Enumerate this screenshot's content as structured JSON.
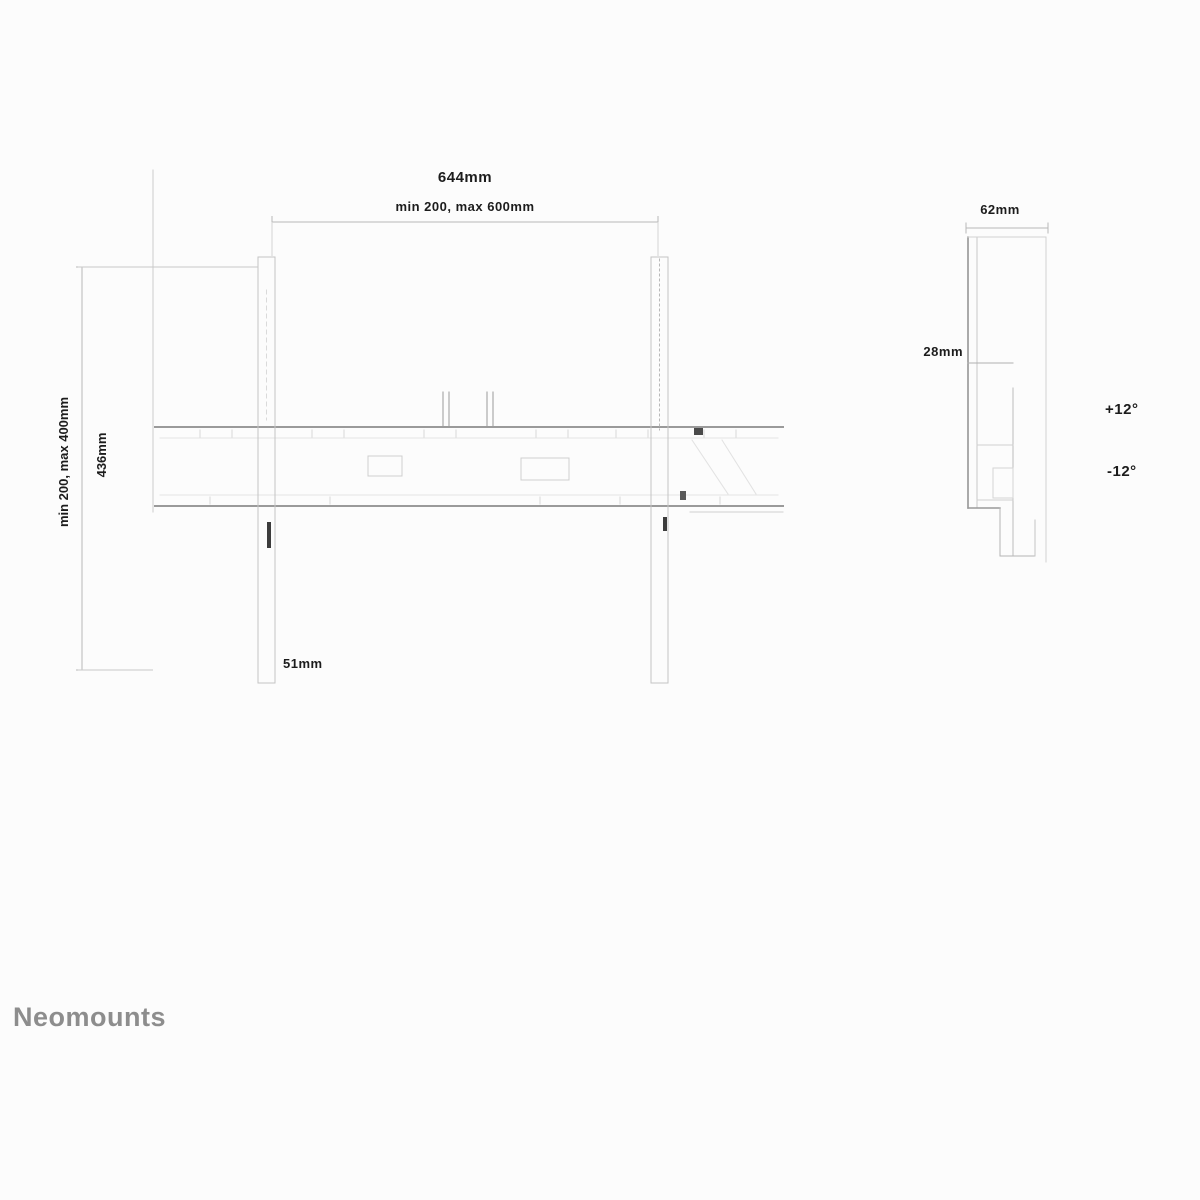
{
  "front_view": {
    "overall_width": "644mm",
    "vesa_width_range": "min 200, max 600mm",
    "vesa_height_range": "min 200, max 400mm",
    "bracket_height": "436mm",
    "bracket_width": "51mm"
  },
  "side_view": {
    "depth": "62mm",
    "wall_distance": "28mm",
    "tilt_up": "+12°",
    "tilt_down": "-12°"
  },
  "brand": "Neomounts"
}
